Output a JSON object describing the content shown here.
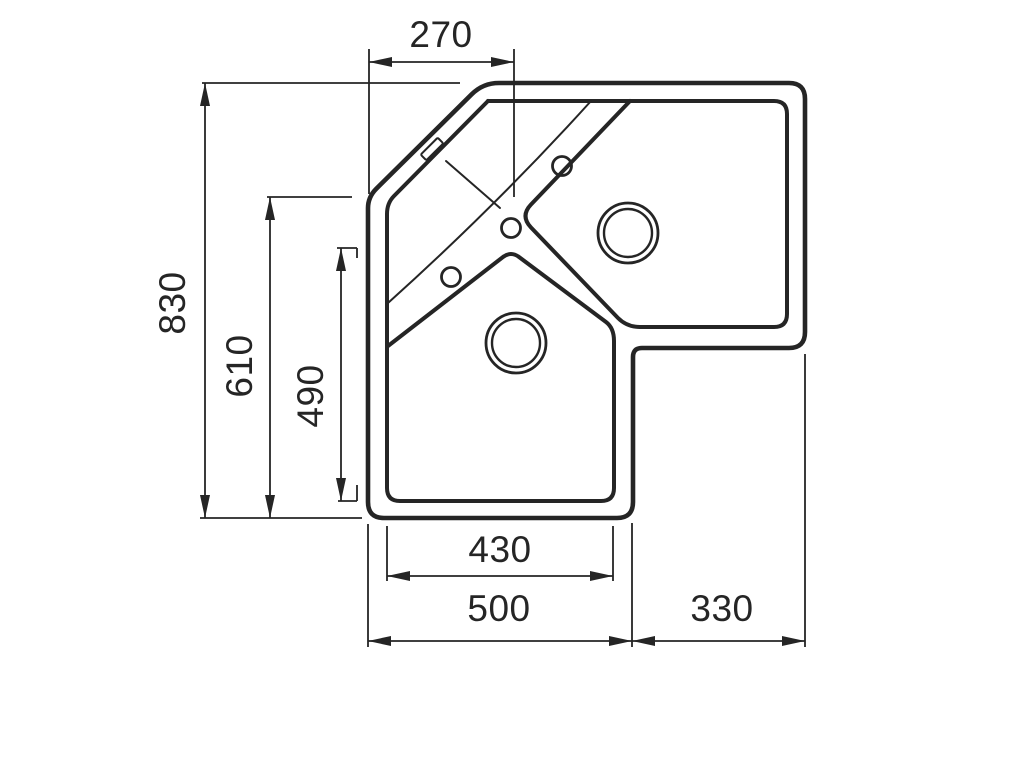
{
  "drawing": {
    "title": "Corner sink technical drawing (top view)",
    "line_color": "#252525",
    "background_color": "#ffffff",
    "dimensions": {
      "faucet_offset_width": "270",
      "overall_height": "830",
      "left_side_height": "610",
      "left_bowl_inner_height": "490",
      "bottom_bowl_inner_width": "430",
      "bottom_overall_width": "500",
      "right_section_width": "330"
    }
  }
}
